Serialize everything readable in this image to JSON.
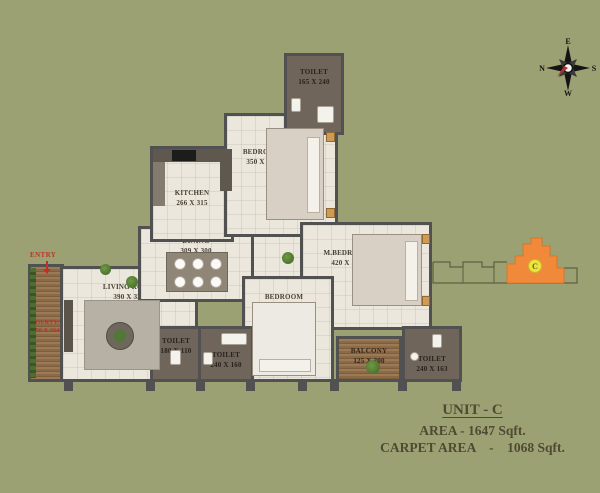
{
  "colors": {
    "background": "#9ca173",
    "wall": "#515152",
    "floor": "#ece7dc",
    "toilet_floor": "#6f655b",
    "wood": "#8a6a48",
    "accent_red": "#c03028",
    "keyplan_orange": "#f08a3a",
    "keyplan_badge_yellow": "#eee23c",
    "info_text": "#4f4a33"
  },
  "compass": {
    "top": "E",
    "right": "S",
    "bottom": "W",
    "left": "N"
  },
  "entry": {
    "label": "ENTRY"
  },
  "rooms": [
    {
      "id": "toilet-top",
      "name": "TOILET",
      "dims": "165 X 240"
    },
    {
      "id": "bedroom-top",
      "name": "BEDROOM",
      "dims": "350 X 385"
    },
    {
      "id": "kitchen",
      "name": "KITCHEN",
      "dims": "266 X 315"
    },
    {
      "id": "dining",
      "name": "DINING",
      "dims": "309 X 300"
    },
    {
      "id": "m-bedroom",
      "name": "M.BEDROOM",
      "dims": "420 X 300"
    },
    {
      "id": "living-room",
      "name": "LIVING ROOM",
      "dims": "390 X 330"
    },
    {
      "id": "bedroom-bottom",
      "name": "BEDROOM",
      "dims": "390 X 300"
    },
    {
      "id": "toilet-left",
      "name": "TOILET",
      "dims": "180 X 110"
    },
    {
      "id": "toilet-mid",
      "name": "TOILET",
      "dims": "240 X 160"
    },
    {
      "id": "balcony",
      "name": "BALCONY",
      "dims": "125 X 300"
    },
    {
      "id": "toilet-right",
      "name": "TOILET",
      "dims": "240 X 163"
    },
    {
      "id": "courtyard",
      "name": "COURTYARD",
      "dims": "150 X 364"
    }
  ],
  "keyplan": {
    "unit_label": "C"
  },
  "info": {
    "unit_title": "UNIT - C",
    "area_line": "AREA - 1647 Sqft.",
    "carpet_line": "CARPET AREA    -    1068 Sqft."
  }
}
